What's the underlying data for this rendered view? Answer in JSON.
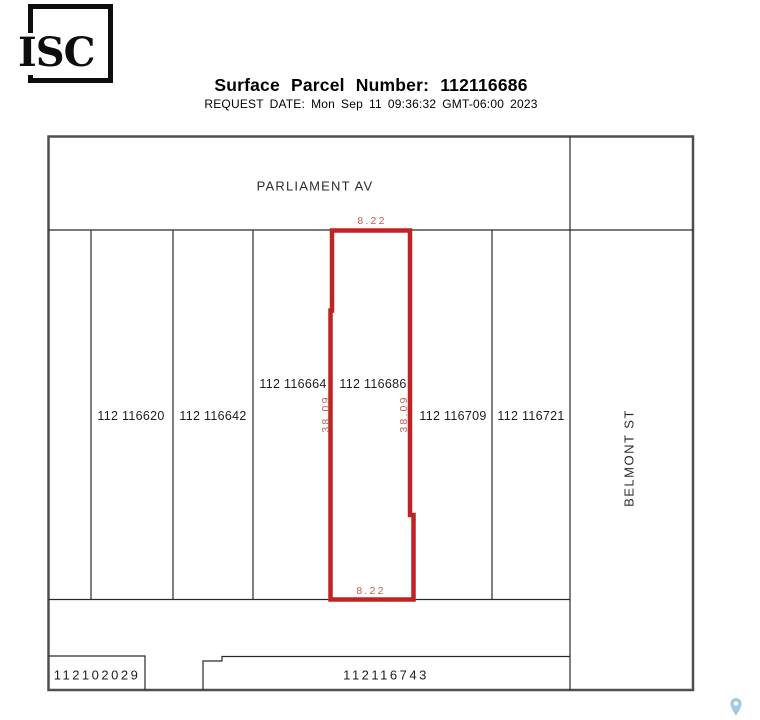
{
  "header": {
    "logo_text": "ISC",
    "title": "Surface Parcel Number: 112116686",
    "request_date": "REQUEST DATE: Mon Sep 11 09:36:32 GMT-06:00 2023"
  },
  "map": {
    "streets": {
      "top": "PARLIAMENT AV",
      "right": "BELMONT ST"
    },
    "highlighted_parcel": {
      "number": "112 116686",
      "dim_top": "8.22",
      "dim_bottom": "8.22",
      "dim_left": "38.09",
      "dim_right": "38.09"
    },
    "parcels": [
      {
        "label": "112 116620"
      },
      {
        "label": "112 116642"
      },
      {
        "label": "112 116664"
      },
      {
        "label": "112 116686"
      },
      {
        "label": "112 116709"
      },
      {
        "label": "112 116721"
      },
      {
        "label": "112102029"
      },
      {
        "label": "112116743"
      }
    ],
    "colors": {
      "highlight": "#bf2323",
      "dimension_text": "#c25b52",
      "outer_border": "#4f4f4f",
      "parcel_line": "#2a2a2a",
      "pin": "#a3c8e2"
    }
  }
}
